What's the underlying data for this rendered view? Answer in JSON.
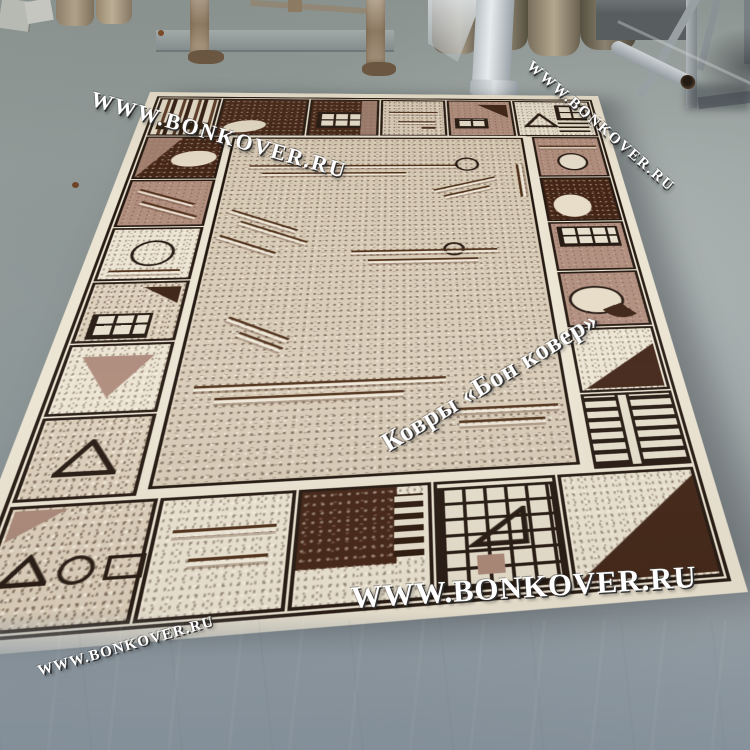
{
  "watermarks": {
    "top_left": "WWW.BONKOVER.RU",
    "top_right": "WWW.BONKOVER.RU",
    "center": "Ковры «Бон ковер»",
    "bottom": "WWW.BONKOVER.RU",
    "bottom_left": "WWW.BONKOVER.RU"
  },
  "palette": {
    "floor": "#97a09e",
    "floor_top": "#8a938f",
    "floor_lower": "#8c97a0",
    "rug_cream": "#ece4d2",
    "rug_beige": "#dccfba",
    "rug_field": "#d8cbb6",
    "dark_brown": "#432415",
    "chocolate": "#5a3220",
    "mauve": "#b18e7e",
    "outline": "#241810",
    "line_brown": "#4f3019",
    "wm_white": "#ffffff",
    "rust": "#8d7a63",
    "metal": "#9aa2a2"
  }
}
